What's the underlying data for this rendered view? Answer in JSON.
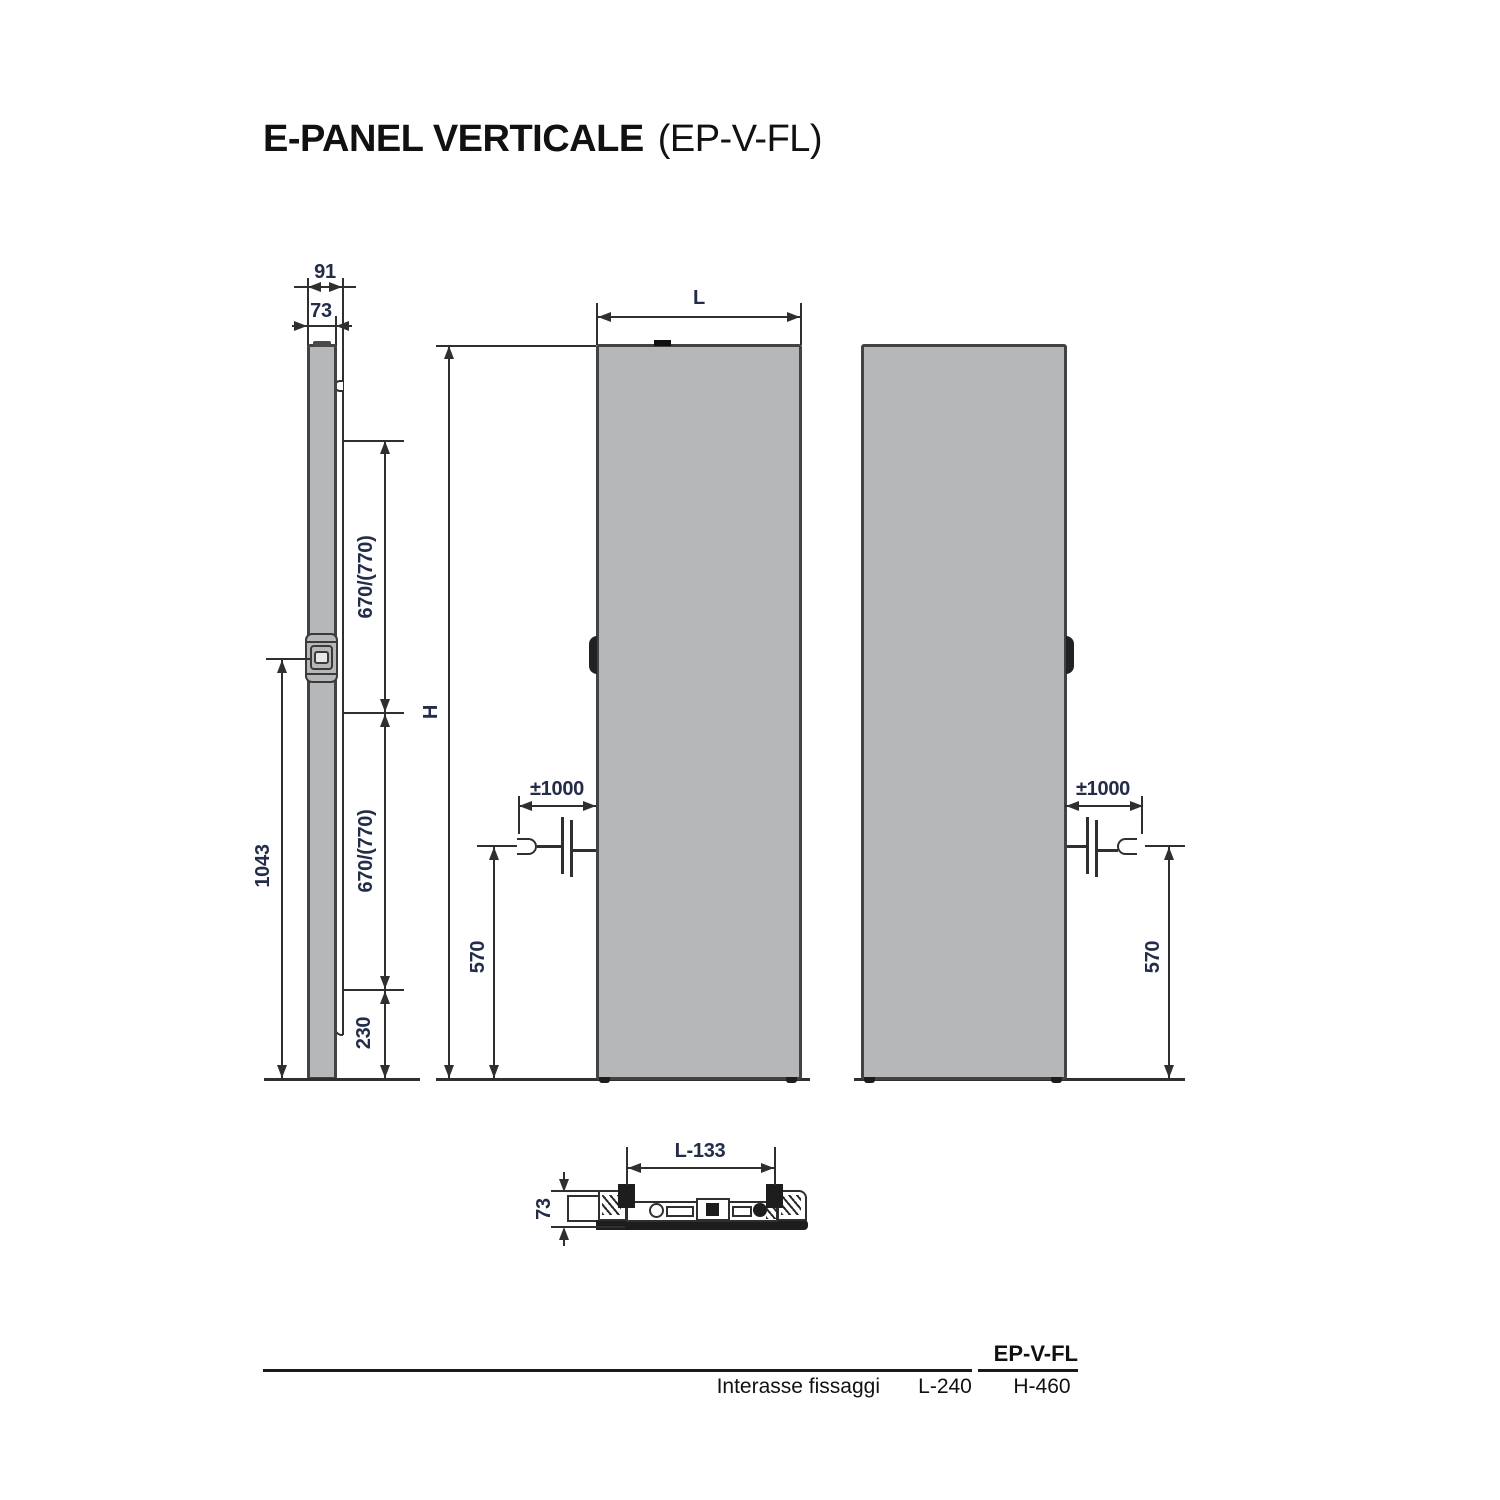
{
  "title": {
    "main": "E-PANEL VERTICALE",
    "suffix": "(EP-V-FL)"
  },
  "side_view": {
    "dim_91": "91",
    "dim_73": "73",
    "dim_670_top": "670/(770)",
    "dim_670_bottom": "670/(770)",
    "dim_230": "230",
    "dim_1043": "1043"
  },
  "front_view": {
    "dim_L": "L",
    "dim_H": "H",
    "dim_cable": "±1000",
    "dim_570": "570"
  },
  "back_view": {
    "dim_cable": "±1000",
    "dim_570": "570"
  },
  "top_view": {
    "dim_L133": "L-133",
    "dim_73": "73"
  },
  "table": {
    "model": "EP-V-FL",
    "row_label": "Interasse fissaggi",
    "l_value": "L-240",
    "h_value": "H-460"
  },
  "colors": {
    "panel_fill": "#b5b7b9",
    "panel_border": "#404244",
    "line": "#2f2f2f",
    "dim_text": "#232c48",
    "text": "#111111"
  }
}
